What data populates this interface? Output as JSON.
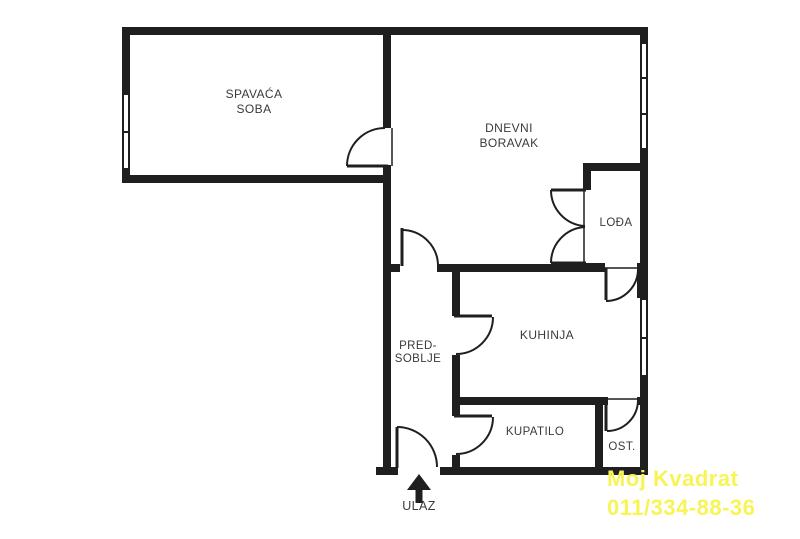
{
  "colors": {
    "background": "#ffffff",
    "wall": "#1f1f1f",
    "label_text": "#3a3a3a",
    "watermark_yellow": "#f8f455"
  },
  "rooms": {
    "bedroom": {
      "label_line1": "SPAVAĆA",
      "label_line2": "SOBA"
    },
    "living_room": {
      "label_line1": "DNEVNI",
      "label_line2": "BORAVAK"
    },
    "loggia": {
      "label": "LOĐA"
    },
    "hallway": {
      "label_line1": "PRED-",
      "label_line2": "SOBLJE"
    },
    "kitchen": {
      "label": "KUHINJA"
    },
    "bathroom": {
      "label": "KUPATILO"
    },
    "storage": {
      "label": "OST."
    }
  },
  "entrance": {
    "label": "ULAZ",
    "arrow_icon": "up-arrow"
  },
  "watermark": {
    "company": "Moj Kvadrat",
    "phone": "011/334-88-36"
  }
}
